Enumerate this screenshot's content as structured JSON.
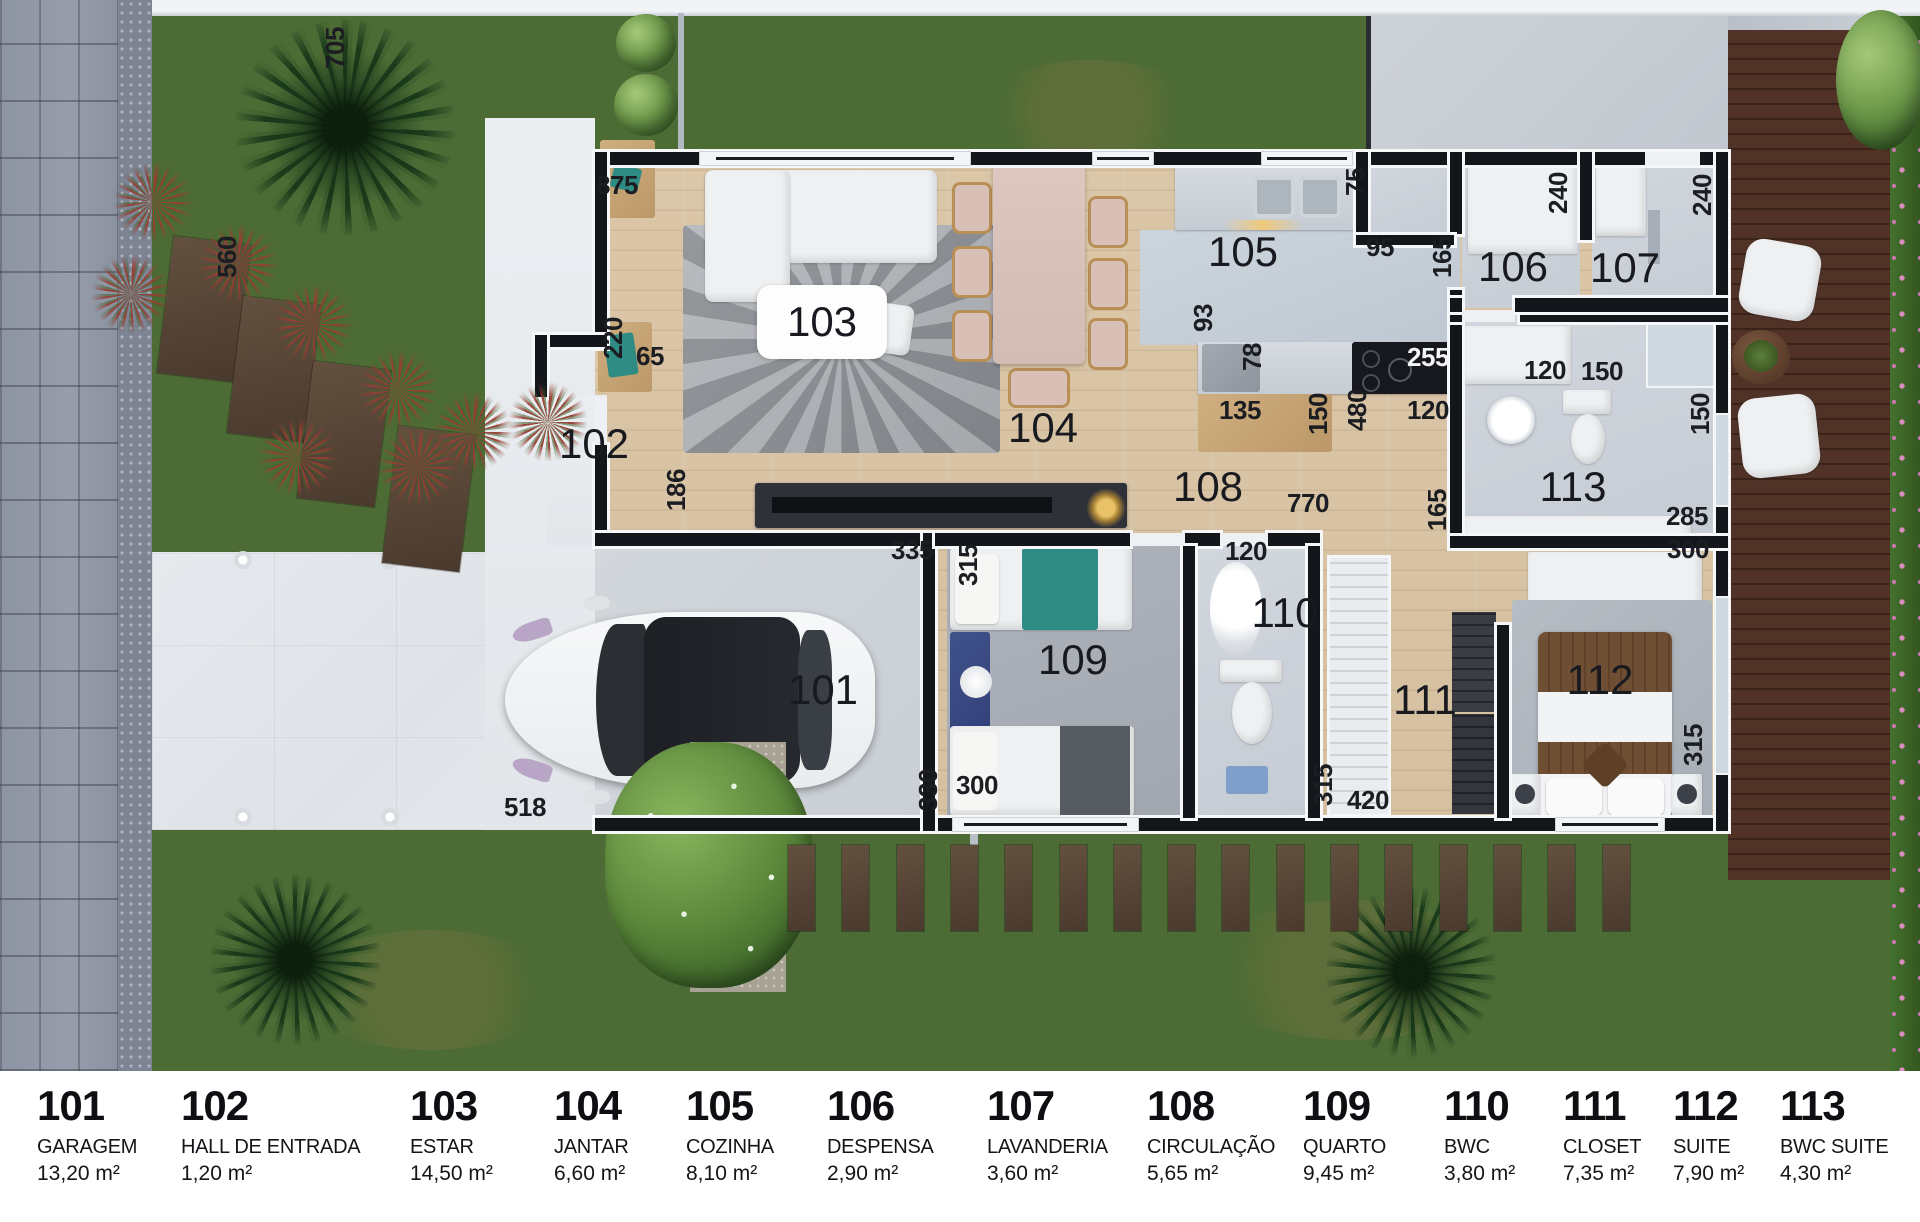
{
  "legend": {
    "items": [
      {
        "number": "101",
        "name": "GARAGEM",
        "area": "13,20 m²",
        "x": 37
      },
      {
        "number": "102",
        "name": "HALL DE ENTRADA",
        "area": "1,20 m²",
        "x": 181
      },
      {
        "number": "103",
        "name": "ESTAR",
        "area": "14,50 m²",
        "x": 410
      },
      {
        "number": "104",
        "name": "JANTAR",
        "area": "6,60 m²",
        "x": 554
      },
      {
        "number": "105",
        "name": "COZINHA",
        "area": "8,10 m²",
        "x": 686
      },
      {
        "number": "106",
        "name": "DESPENSA",
        "area": "2,90 m²",
        "x": 827
      },
      {
        "number": "107",
        "name": "LAVANDERIA",
        "area": "3,60 m²",
        "x": 987
      },
      {
        "number": "108",
        "name": "CIRCULAÇÃO",
        "area": "5,65 m²",
        "x": 1147
      },
      {
        "number": "109",
        "name": "QUARTO",
        "area": "9,45 m²",
        "x": 1303
      },
      {
        "number": "110",
        "name": "BWC",
        "area": "3,80 m²",
        "x": 1444
      },
      {
        "number": "111",
        "name": "CLOSET",
        "area": "7,35 m²",
        "x": 1563
      },
      {
        "number": "112",
        "name": "SUITE",
        "area": "7,90 m²",
        "x": 1673
      },
      {
        "number": "113",
        "name": "BWC SUITE",
        "area": "4,30 m²",
        "x": 1780
      }
    ]
  },
  "plan": {
    "room_labels": [
      {
        "num": "101",
        "x": 823,
        "y": 690
      },
      {
        "num": "102",
        "x": 594,
        "y": 444
      },
      {
        "num": "103",
        "x": 822,
        "y": 322,
        "plate": true
      },
      {
        "num": "104",
        "x": 1043,
        "y": 428
      },
      {
        "num": "105",
        "x": 1243,
        "y": 252
      },
      {
        "num": "106",
        "x": 1513,
        "y": 267
      },
      {
        "num": "107",
        "x": 1625,
        "y": 268
      },
      {
        "num": "108",
        "x": 1208,
        "y": 487
      },
      {
        "num": "109",
        "x": 1073,
        "y": 660
      },
      {
        "num": "110",
        "x": 1285,
        "y": 613
      },
      {
        "num": "111",
        "x": 1425,
        "y": 700
      },
      {
        "num": "112",
        "x": 1600,
        "y": 680
      },
      {
        "num": "113",
        "x": 1573,
        "y": 487
      }
    ],
    "dimensions": [
      {
        "text": "705",
        "x": 335,
        "y": 48,
        "v": true
      },
      {
        "text": "560",
        "x": 227,
        "y": 257,
        "v": true
      },
      {
        "text": "875",
        "x": 617,
        "y": 185
      },
      {
        "text": "220",
        "x": 613,
        "y": 338,
        "v": true
      },
      {
        "text": "65",
        "x": 650,
        "y": 356
      },
      {
        "text": "186",
        "x": 676,
        "y": 490,
        "v": true
      },
      {
        "text": "93",
        "x": 1203,
        "y": 318,
        "v": true
      },
      {
        "text": "78",
        "x": 1252,
        "y": 357,
        "v": true
      },
      {
        "text": "255",
        "x": 1428,
        "y": 357,
        "light": true
      },
      {
        "text": "135",
        "x": 1240,
        "y": 410
      },
      {
        "text": "150",
        "x": 1318,
        "y": 414,
        "v": true
      },
      {
        "text": "480",
        "x": 1357,
        "y": 410,
        "v": true
      },
      {
        "text": "120",
        "x": 1428,
        "y": 410
      },
      {
        "text": "75",
        "x": 1355,
        "y": 182,
        "v": true
      },
      {
        "text": "95",
        "x": 1380,
        "y": 247
      },
      {
        "text": "165",
        "x": 1442,
        "y": 257,
        "v": true
      },
      {
        "text": "240",
        "x": 1558,
        "y": 193,
        "v": true
      },
      {
        "text": "240",
        "x": 1702,
        "y": 195,
        "v": true
      },
      {
        "text": "120",
        "x": 1545,
        "y": 370
      },
      {
        "text": "150",
        "x": 1602,
        "y": 371
      },
      {
        "text": "150",
        "x": 1700,
        "y": 414,
        "v": true
      },
      {
        "text": "770",
        "x": 1308,
        "y": 503
      },
      {
        "text": "165",
        "x": 1437,
        "y": 510,
        "v": true
      },
      {
        "text": "285",
        "x": 1687,
        "y": 516
      },
      {
        "text": "300",
        "x": 1688,
        "y": 549
      },
      {
        "text": "120",
        "x": 1246,
        "y": 551
      },
      {
        "text": "335",
        "x": 912,
        "y": 550
      },
      {
        "text": "315",
        "x": 968,
        "y": 565,
        "v": true
      },
      {
        "text": "300",
        "x": 977,
        "y": 785
      },
      {
        "text": "330",
        "x": 928,
        "y": 790,
        "v": true
      },
      {
        "text": "518",
        "x": 525,
        "y": 807
      },
      {
        "text": "315",
        "x": 1323,
        "y": 785,
        "v": true
      },
      {
        "text": "420",
        "x": 1368,
        "y": 800
      },
      {
        "text": "315",
        "x": 1693,
        "y": 745,
        "v": true
      }
    ]
  },
  "colors": {
    "wall": "#14161c",
    "grass": "#4d6c35",
    "deck_wood": "#503227",
    "concrete": "#e2e6ea",
    "floor_wood": "#d8c3a3",
    "accent_teal": "#2e8c85"
  }
}
